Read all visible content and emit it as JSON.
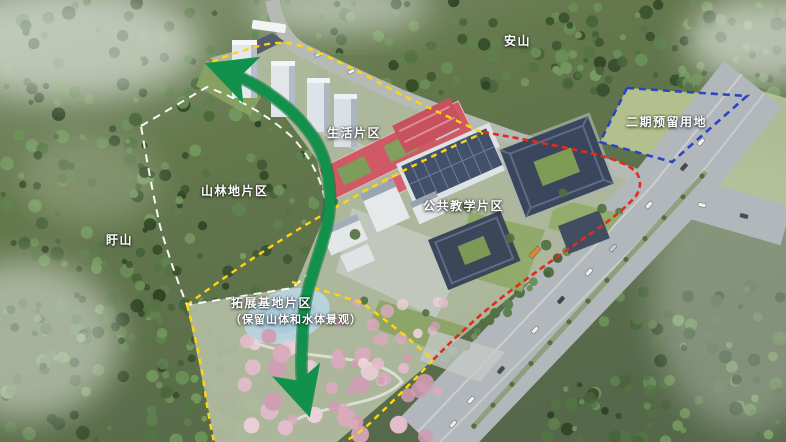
{
  "labels": {
    "mountain_top": "安山",
    "phase2_reserved": "二期预留用地",
    "living_zone": "生活片区",
    "forest_zone": "山林地片区",
    "mountain_left": "盱山",
    "teaching_zone": "公共教学片区",
    "expansion_zone": "拓展基地片区",
    "expansion_note": "（保留山体和水体景观）"
  },
  "legend_colors": {
    "phase2_boundary": "#2a45c4",
    "campus_redline": "#e32a1c",
    "zone_divider": "#ffd60a",
    "forest_boundary": "#ffffff",
    "green_axis_arrow": "#12914c"
  }
}
